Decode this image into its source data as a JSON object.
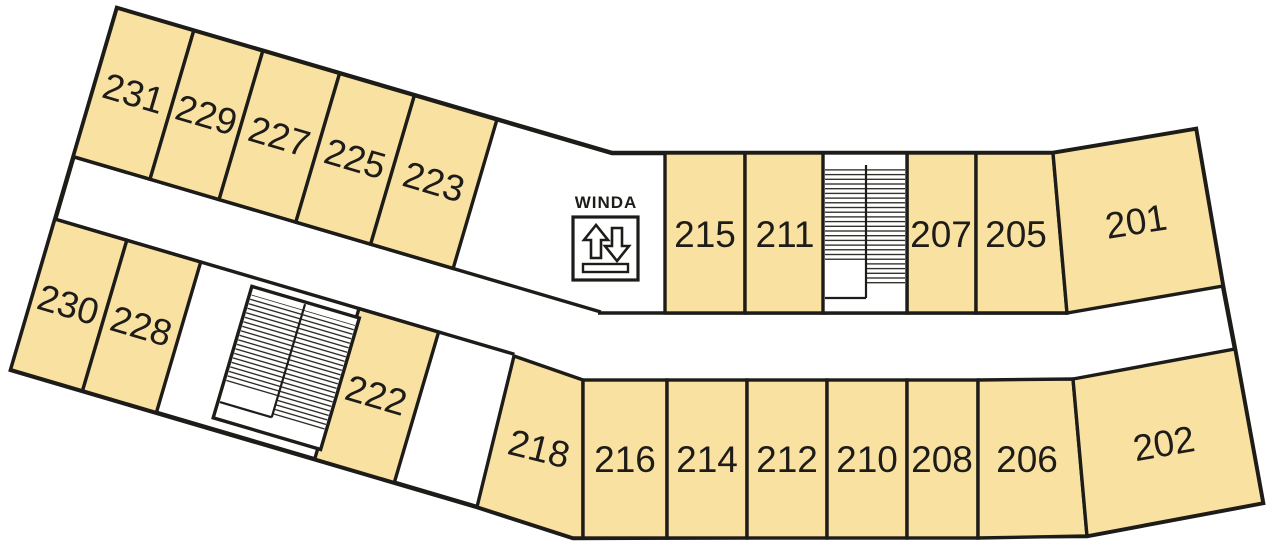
{
  "plan": {
    "elevator": {
      "label": "WINDA"
    },
    "colors": {
      "room_fill": "#F8E1A1",
      "wall_line": "#1E1C18",
      "floor_background": "#FFFFFF"
    },
    "stairwells": [
      {
        "name": "stairwell-lower-left"
      },
      {
        "name": "stairwell-upper-middle"
      }
    ],
    "rooms": [
      {
        "number": "231"
      },
      {
        "number": "229"
      },
      {
        "number": "227"
      },
      {
        "number": "225"
      },
      {
        "number": "223"
      },
      {
        "number": "230"
      },
      {
        "number": "228"
      },
      {
        "number": "222"
      },
      {
        "number": "218"
      },
      {
        "number": "215"
      },
      {
        "number": "211"
      },
      {
        "number": "207"
      },
      {
        "number": "205"
      },
      {
        "number": "201"
      },
      {
        "number": "216"
      },
      {
        "number": "214"
      },
      {
        "number": "212"
      },
      {
        "number": "210"
      },
      {
        "number": "208"
      },
      {
        "number": "206"
      },
      {
        "number": "202"
      }
    ]
  }
}
